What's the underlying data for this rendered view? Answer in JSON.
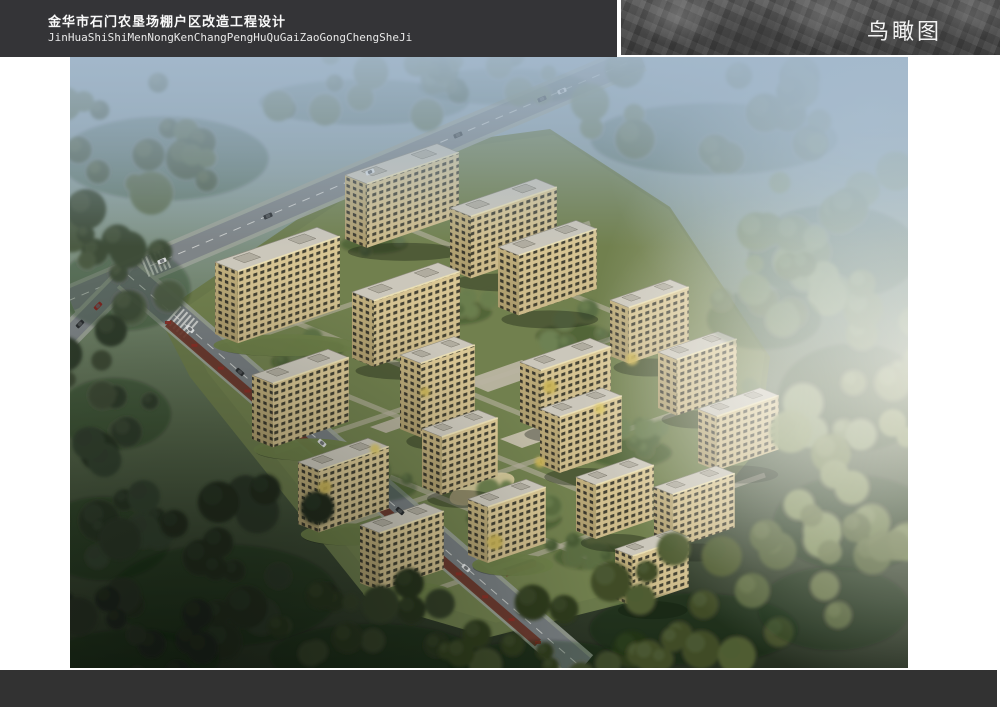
{
  "header": {
    "title_cn": "金华市石门农垦场棚户区改造工程设计",
    "title_pinyin": "JinHuaShiShiMenNongKenChangPengHuQuGaiZaoGongChengSheJi",
    "view_label": "鸟瞰图"
  },
  "colors": {
    "header_bg": "#343437",
    "footer_bg": "#323232",
    "page_bg": "#ffffff",
    "facade": "#dcc996",
    "facade_side": "#c2b07d",
    "window": "#46443五",
    "roof": "#cbc7bb",
    "road": "#7e8487",
    "sidewalk": "#9aa197",
    "lawn": "#6b7a4b",
    "haze_top": "#a3b8cb",
    "shop_strip": "#6a3327"
  },
  "scene": {
    "iso": {
      "su": 0.34,
      "vx": 0.52,
      "vy": 0.21
    },
    "site": [
      [
        88,
        258
      ],
      [
        330,
        92
      ],
      [
        480,
        72
      ],
      [
        600,
        150
      ],
      [
        700,
        300
      ],
      [
        688,
        392
      ],
      [
        560,
        545
      ],
      [
        420,
        580
      ],
      [
        300,
        545
      ],
      [
        120,
        320
      ]
    ],
    "roads": [
      {
        "x1": 571,
        "y1": 0,
        "x2": 0,
        "y2": 243,
        "sw": 30,
        "aw": 22,
        "dash": true,
        "asphalt": "#7e8487"
      },
      {
        "x1": 58,
        "y1": 218,
        "x2": -14,
        "y2": 292,
        "sw": 24,
        "aw": 16,
        "dash": false,
        "asphalt": "#7b8184"
      },
      {
        "x1": 58,
        "y1": 218,
        "x2": 512,
        "y2": 611,
        "sw": 34,
        "aw": 26,
        "dash": true,
        "asphalt": "#767c7f"
      }
    ],
    "crosswalks": [
      {
        "x": 112,
        "y": 265,
        "ang": 40.9,
        "n": 6,
        "sp": 4.5,
        "w": 22
      },
      {
        "x": 86,
        "y": 206,
        "ang": -23,
        "n": 6,
        "sp": 4.5,
        "w": 20
      }
    ],
    "paths": [
      {
        "pts": [
          [
            150,
            292
          ],
          [
            520,
            166
          ]
        ]
      },
      {
        "pts": [
          [
            205,
            395
          ],
          [
            600,
            262
          ]
        ]
      },
      {
        "pts": [
          [
            262,
            472
          ],
          [
            648,
            342
          ]
        ]
      },
      {
        "pts": [
          [
            335,
            543
          ],
          [
            695,
            418
          ]
        ]
      },
      {
        "pts": [
          [
            310,
            160
          ],
          [
            620,
            286
          ]
        ]
      },
      {
        "pts": [
          [
            200,
            255
          ],
          [
            510,
            381
          ]
        ]
      },
      {
        "pts": [
          [
            255,
            330
          ],
          [
            565,
            456
          ]
        ]
      },
      {
        "pts": [
          [
            320,
            420
          ],
          [
            600,
            534
          ]
        ]
      }
    ],
    "plazas": [
      {
        "pts": [
          [
            392,
            324
          ],
          [
            452,
            303
          ],
          [
            478,
            314
          ],
          [
            418,
            335
          ]
        ],
        "c": "#b9b4a1"
      },
      {
        "pts": [
          [
            430,
            382
          ],
          [
            482,
            364
          ],
          [
            504,
            373
          ],
          [
            452,
            391
          ]
        ],
        "c": "#c4beab"
      },
      {
        "pts": [
          [
            300,
            370
          ],
          [
            340,
            356
          ],
          [
            356,
            362
          ],
          [
            316,
            376
          ]
        ],
        "c": "#b5b09d"
      }
    ],
    "playground": {
      "cx": 412,
      "cy": 432,
      "rx": 34,
      "ry": 13,
      "rot": -19,
      "c": "#d9cb9e"
    },
    "shops_strip": {
      "x1": 98,
      "y1": 266,
      "x2": 468,
      "y2": 586,
      "w": 9,
      "c": "#6a3327",
      "awning": "#8c2e27",
      "n": 15
    },
    "community": {
      "x": 300,
      "y": 266,
      "w": 82,
      "d": 15,
      "c": "#23261e",
      "ridge": "#cfd2c6"
    },
    "gates": [
      {
        "x": 352,
        "y": 240,
        "w": 34,
        "d": 8
      },
      {
        "x": 432,
        "y": 512,
        "w": 30,
        "d": 8
      }
    ],
    "buildings": [
      {
        "x": 275,
        "y": 118,
        "w": 92,
        "d": 42,
        "h": 64
      },
      {
        "x": 380,
        "y": 151,
        "w": 86,
        "d": 40,
        "h": 62
      },
      {
        "x": 145,
        "y": 205,
        "w": 102,
        "d": 44,
        "h": 72,
        "pod": true
      },
      {
        "x": 282,
        "y": 235,
        "w": 86,
        "d": 42,
        "h": 66
      },
      {
        "x": 428,
        "y": 190,
        "w": 78,
        "d": 40,
        "h": 60
      },
      {
        "x": 540,
        "y": 243,
        "w": 60,
        "d": 36,
        "h": 56
      },
      {
        "x": 588,
        "y": 295,
        "w": 60,
        "d": 36,
        "h": 56
      },
      {
        "x": 182,
        "y": 318,
        "w": 76,
        "d": 40,
        "h": 64,
        "pod": true
      },
      {
        "x": 330,
        "y": 298,
        "w": 54,
        "d": 40,
        "h": 74
      },
      {
        "x": 450,
        "y": 305,
        "w": 70,
        "d": 40,
        "h": 60
      },
      {
        "x": 628,
        "y": 352,
        "w": 62,
        "d": 36,
        "h": 54
      },
      {
        "x": 228,
        "y": 405,
        "w": 70,
        "d": 40,
        "h": 62,
        "pod": true
      },
      {
        "x": 352,
        "y": 372,
        "w": 56,
        "d": 38,
        "h": 58
      },
      {
        "x": 470,
        "y": 352,
        "w": 62,
        "d": 38,
        "h": 56
      },
      {
        "x": 290,
        "y": 468,
        "w": 64,
        "d": 38,
        "h": 58,
        "pod": true
      },
      {
        "x": 398,
        "y": 442,
        "w": 58,
        "d": 38,
        "h": 56,
        "pod": true
      },
      {
        "x": 506,
        "y": 420,
        "w": 58,
        "d": 38,
        "h": 54
      },
      {
        "x": 584,
        "y": 430,
        "w": 62,
        "d": 36,
        "h": 54
      },
      {
        "x": 545,
        "y": 492,
        "w": 56,
        "d": 34,
        "h": 50
      }
    ],
    "tree_clusters": [
      {
        "x": 90,
        "y": 70,
        "rx": 110,
        "ry": 70,
        "n": 16,
        "s": 16,
        "c1": "#47573f",
        "c2": "#5a6a4c",
        "o": 0.85,
        "outer": true
      },
      {
        "x": 50,
        "y": 200,
        "rx": 70,
        "ry": 70,
        "n": 12,
        "s": 15,
        "c1": "#3a4834",
        "c2": "#4a5840",
        "o": 0.95,
        "outer": true
      },
      {
        "x": 290,
        "y": 28,
        "rx": 110,
        "ry": 38,
        "n": 14,
        "s": 13,
        "c1": "#4c5c42",
        "c2": "#5f6f50",
        "o": 0.8,
        "outer": true
      },
      {
        "x": 430,
        "y": 16,
        "rx": 90,
        "ry": 30,
        "n": 10,
        "s": 12,
        "c1": "#556548",
        "c2": "#677756",
        "o": 0.75,
        "outer": true
      },
      {
        "x": 640,
        "y": 55,
        "rx": 130,
        "ry": 60,
        "n": 16,
        "s": 16,
        "c1": "#5a6a4c",
        "c2": "#6d7d5a",
        "o": 0.8,
        "outer": true
      },
      {
        "x": 760,
        "y": 160,
        "rx": 90,
        "ry": 80,
        "n": 14,
        "s": 16,
        "c1": "#687a52",
        "c2": "#7c8e64",
        "o": 0.85,
        "outer": true
      },
      {
        "x": 780,
        "y": 300,
        "rx": 80,
        "ry": 90,
        "n": 14,
        "s": 16,
        "c1": "#76865a",
        "c2": "#8a9a6e",
        "o": 0.9,
        "outer": true
      },
      {
        "x": 780,
        "y": 430,
        "rx": 85,
        "ry": 80,
        "n": 14,
        "s": 16,
        "c1": "#6e7e4e",
        "c2": "#839260",
        "o": 0.95,
        "outer": true
      },
      {
        "x": 40,
        "y": 330,
        "rx": 60,
        "ry": 60,
        "n": 10,
        "s": 14,
        "c1": "#2f3b2b",
        "c2": "#3d4936",
        "o": 1,
        "outer": true
      },
      {
        "x": 30,
        "y": 450,
        "rx": 70,
        "ry": 70,
        "n": 12,
        "s": 15,
        "c1": "#273124",
        "c2": "#333f2e",
        "o": 1,
        "outer": true
      },
      {
        "x": 150,
        "y": 500,
        "rx": 120,
        "ry": 85,
        "n": 18,
        "s": 17,
        "c1": "#20291e",
        "c2": "#2c3627",
        "o": 1,
        "outer": true
      },
      {
        "x": 60,
        "y": 580,
        "rx": 90,
        "ry": 50,
        "n": 12,
        "s": 15,
        "c1": "#1b231a",
        "c2": "#262f22",
        "o": 1,
        "outer": true
      },
      {
        "x": 300,
        "y": 575,
        "rx": 110,
        "ry": 55,
        "n": 14,
        "s": 15,
        "c1": "#27311d",
        "c2": "#333e26",
        "o": 1,
        "outer": true
      },
      {
        "x": 470,
        "y": 590,
        "rx": 100,
        "ry": 45,
        "n": 12,
        "s": 14,
        "c1": "#2f3a1f",
        "c2": "#3c4829",
        "o": 1,
        "outer": true
      },
      {
        "x": 620,
        "y": 545,
        "rx": 110,
        "ry": 60,
        "n": 14,
        "s": 15,
        "c1": "#3f4c28",
        "c2": "#4f5c33",
        "o": 1,
        "outer": true
      },
      {
        "x": 760,
        "y": 520,
        "rx": 80,
        "ry": 70,
        "n": 12,
        "s": 15,
        "c1": "#55643a",
        "c2": "#687548",
        "o": 0.95,
        "outer": true
      },
      {
        "x": 690,
        "y": 240,
        "rx": 60,
        "ry": 50,
        "n": 10,
        "s": 13,
        "c1": "#5e7048",
        "c2": "#71845a",
        "o": 0.85,
        "outer": true
      },
      {
        "x": 235,
        "y": 295,
        "rx": 40,
        "ry": 22,
        "n": 8,
        "s": 9,
        "c1": "#4e6138",
        "c2": "#617547",
        "o": 1
      },
      {
        "x": 375,
        "y": 245,
        "rx": 45,
        "ry": 22,
        "n": 8,
        "s": 9,
        "c1": "#566a3e",
        "c2": "#6a7e4e",
        "o": 1
      },
      {
        "x": 500,
        "y": 270,
        "rx": 40,
        "ry": 20,
        "n": 7,
        "s": 9,
        "c1": "#5a6e44",
        "c2": "#6d8153",
        "o": 1
      },
      {
        "x": 300,
        "y": 420,
        "rx": 45,
        "ry": 24,
        "n": 8,
        "s": 9,
        "c1": "#52653c",
        "c2": "#66794b",
        "o": 1
      },
      {
        "x": 440,
        "y": 450,
        "rx": 50,
        "ry": 26,
        "n": 9,
        "s": 10,
        "c1": "#5a6d40",
        "c2": "#6e8150",
        "o": 1
      },
      {
        "x": 555,
        "y": 385,
        "rx": 45,
        "ry": 24,
        "n": 8,
        "s": 9,
        "c1": "#566a40",
        "c2": "#697d4f",
        "o": 1
      },
      {
        "x": 620,
        "y": 450,
        "rx": 40,
        "ry": 22,
        "n": 7,
        "s": 9,
        "c1": "#4c5f38",
        "c2": "#5f7246",
        "o": 1
      },
      {
        "x": 190,
        "y": 250,
        "rx": 30,
        "ry": 16,
        "n": 6,
        "s": 8,
        "c1": "#4a5d36",
        "c2": "#5d7045",
        "o": 1
      },
      {
        "x": 520,
        "y": 490,
        "rx": 42,
        "ry": 22,
        "n": 8,
        "s": 9,
        "c1": "#485b34",
        "c2": "#5b6e43",
        "o": 1
      },
      {
        "x": 660,
        "y": 340,
        "rx": 32,
        "ry": 18,
        "n": 6,
        "s": 8,
        "c1": "#52653e",
        "c2": "#65784d",
        "o": 1
      },
      {
        "x": 420,
        "y": 180,
        "rx": 40,
        "ry": 18,
        "n": 7,
        "s": 8,
        "c1": "#586c40",
        "c2": "#6b7f50",
        "o": 1
      },
      {
        "x": 300,
        "y": 180,
        "rx": 35,
        "ry": 16,
        "n": 6,
        "s": 8,
        "c1": "#506340",
        "c2": "#63764f",
        "o": 1
      }
    ],
    "accent_trees": [
      {
        "x": 355,
        "y": 335
      },
      {
        "x": 470,
        "y": 405
      },
      {
        "x": 530,
        "y": 352
      },
      {
        "x": 305,
        "y": 392
      },
      {
        "x": 562,
        "y": 302
      },
      {
        "x": 425,
        "y": 485
      },
      {
        "x": 255,
        "y": 430
      },
      {
        "x": 480,
        "y": 330
      }
    ],
    "cars": [
      {
        "x": 492,
        "y": 34,
        "a": -23,
        "c": "#e8e8e8"
      },
      {
        "x": 472,
        "y": 42,
        "a": -23,
        "c": "#2a2d30"
      },
      {
        "x": 388,
        "y": 78,
        "a": -23,
        "c": "#34383b"
      },
      {
        "x": 300,
        "y": 115,
        "a": -23,
        "c": "#dfe2e4"
      },
      {
        "x": 198,
        "y": 159,
        "a": -23,
        "c": "#2a2d30"
      },
      {
        "x": 92,
        "y": 204,
        "a": -23,
        "c": "#d8dadb"
      },
      {
        "x": 28,
        "y": 249,
        "a": -46,
        "c": "#7a2620"
      },
      {
        "x": 10,
        "y": 267,
        "a": -46,
        "c": "#2a2d30"
      },
      {
        "x": 120,
        "y": 272,
        "a": 41,
        "c": "#e5e7e8"
      },
      {
        "x": 170,
        "y": 315,
        "a": 41,
        "c": "#2d3033"
      },
      {
        "x": 252,
        "y": 386,
        "a": 41,
        "c": "#dcdedf"
      },
      {
        "x": 330,
        "y": 454,
        "a": 41,
        "c": "#2a2d30"
      },
      {
        "x": 396,
        "y": 511,
        "a": 41,
        "c": "#e2e4e5"
      }
    ]
  }
}
